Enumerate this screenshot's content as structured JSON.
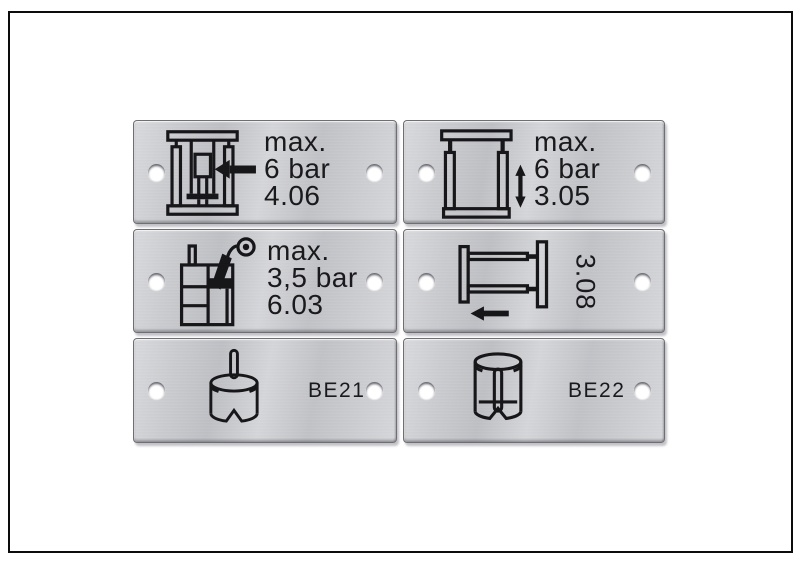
{
  "figure": {
    "description_label": "set of six engraved aluminium machine nameplates",
    "background": "#ffffff",
    "frame_border_color": "#0c0c0c"
  },
  "colors": {
    "plate_face": "#c9cacd",
    "plate_edge": "#6e6f73",
    "engraving": "#17171a",
    "hole": "#ffffff"
  },
  "plates": [
    {
      "name": "plate-4-06",
      "icon": "press-ram-left-arrow-icon",
      "lines": [
        "max.",
        "6 bar",
        "4.06"
      ]
    },
    {
      "name": "plate-3-05",
      "icon": "vertical-slide-double-arrow-icon",
      "lines": [
        "max.",
        "6 bar",
        "3.05"
      ]
    },
    {
      "name": "plate-6-03",
      "icon": "tank-spray-gun-icon",
      "lines": [
        "max.",
        "3,5 bar",
        "6.03"
      ]
    },
    {
      "name": "plate-3-08",
      "icon": "horizontal-slide-left-arrow-icon",
      "rotated_label": "3.08"
    },
    {
      "name": "plate-be21",
      "icon": "die-with-center-pin-icon",
      "label": "BE21"
    },
    {
      "name": "plate-be22",
      "icon": "sleeve-with-inner-pin-icon",
      "label": "BE22"
    }
  ]
}
